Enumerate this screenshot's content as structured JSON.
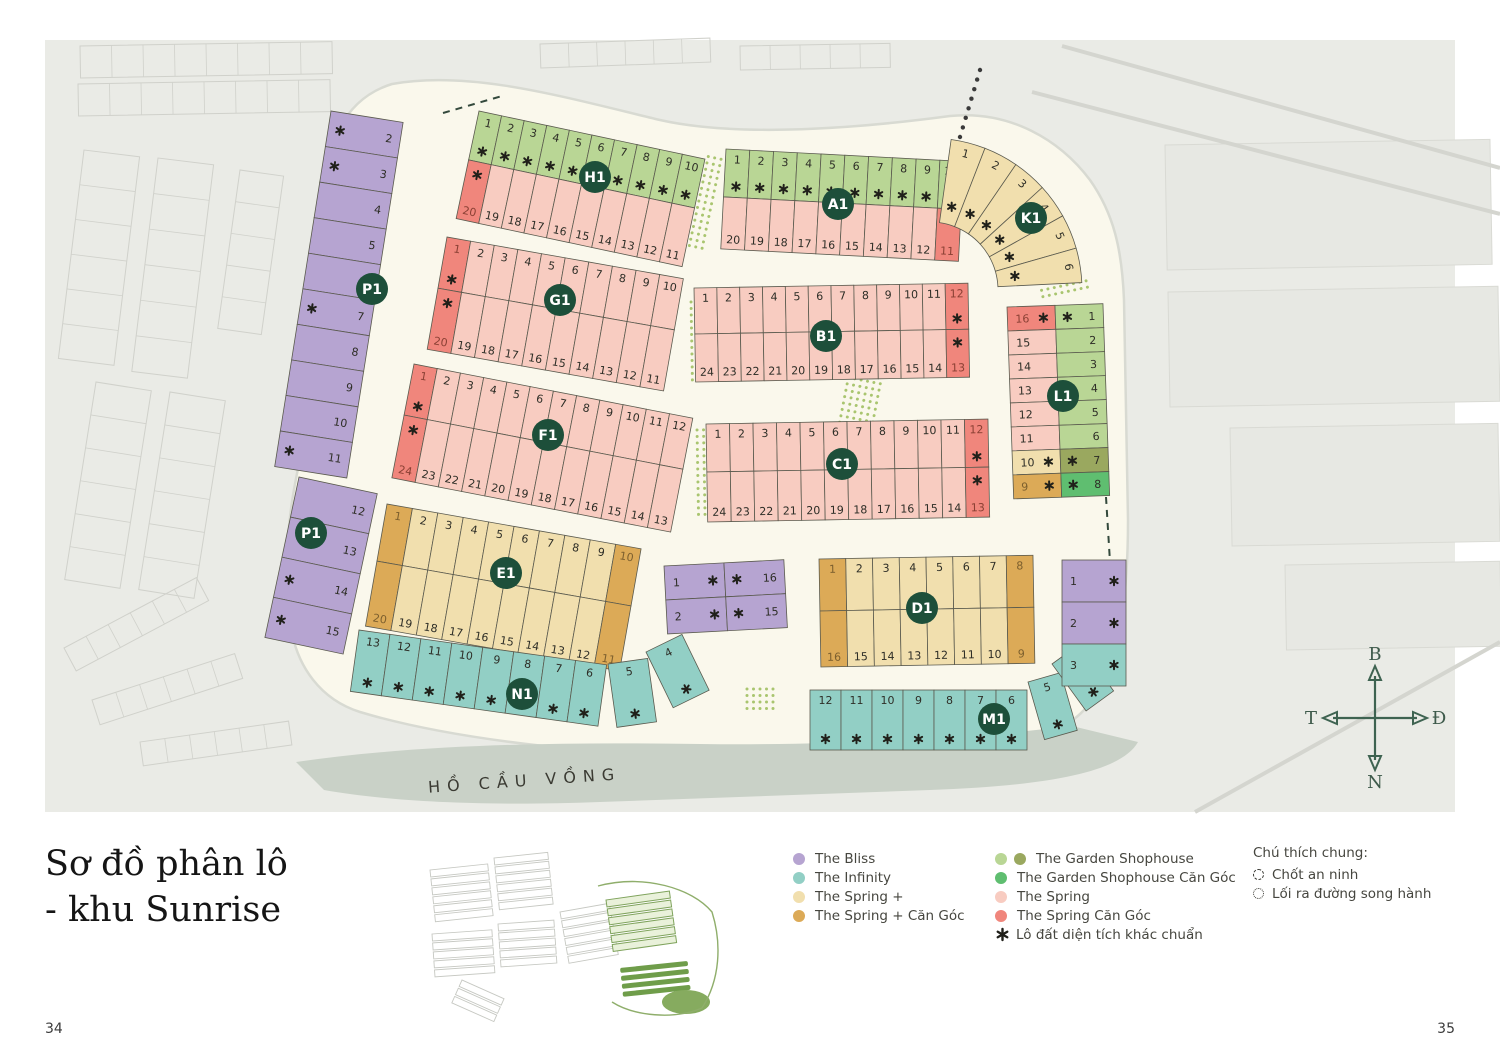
{
  "page": {
    "number_left": "34",
    "number_right": "35"
  },
  "title": {
    "line1": "Sơ đồ phân lô",
    "line2": "- khu Sunrise"
  },
  "map": {
    "lake_label": "HỒ CẦU VỒNG",
    "compass": {
      "north": "B",
      "south": "N",
      "west": "T",
      "east": "Đ"
    },
    "colors": {
      "b": "#b6a4d1",
      "i": "#92cfc5",
      "y": "#f1dfae",
      "Y": "#dcaa57",
      "g": "#b9d695",
      "o": "#9aa85f",
      "G": "#5fbe70",
      "p": "#f8ccc1",
      "r": "#f0867c"
    },
    "numColors": {
      "r": "#8a4034",
      "Y": "#7c5f2e",
      "default": "#2e2e27"
    },
    "badge_color": "#1d4f3a",
    "badges": [
      [
        "H1",
        595,
        177
      ],
      [
        "A1",
        838,
        204
      ],
      [
        "K1",
        1031,
        218
      ],
      [
        "P1",
        372,
        289
      ],
      [
        "G1",
        560,
        300
      ],
      [
        "B1",
        826,
        336
      ],
      [
        "L1",
        1063,
        396
      ],
      [
        "F1",
        548,
        435
      ],
      [
        "C1",
        842,
        464
      ],
      [
        "P1",
        311,
        533
      ],
      [
        "E1",
        506,
        573
      ],
      [
        "D1",
        922,
        608
      ],
      [
        "N1",
        522,
        694
      ],
      [
        "M1",
        994,
        719
      ]
    ],
    "blocks": {
      "strips": [
        {
          "id": "H1",
          "x": 479,
          "y": 111,
          "w": 231,
          "rot": 12,
          "rows": [
            {
              "h": 50,
              "side": "top",
              "nums": [
                "1",
                "2",
                "3",
                "4",
                "5",
                "6",
                "7",
                "8",
                "9",
                "10"
              ],
              "c": "g",
              "ast": [
                0,
                1,
                2,
                3,
                4,
                5,
                6,
                7,
                8,
                9
              ]
            },
            {
              "h": 60,
              "side": "bottom",
              "nums": [
                "20",
                "19",
                "18",
                "17",
                "16",
                "15",
                "14",
                "13",
                "12",
                "11"
              ],
              "c": "p",
              "corner": {
                "0": "r"
              },
              "ast": [
                0
              ]
            }
          ]
        },
        {
          "id": "A1",
          "x": 726,
          "y": 149,
          "w": 238,
          "rot": 3,
          "rows": [
            {
              "h": 48,
              "side": "top",
              "nums": [
                "1",
                "2",
                "3",
                "4",
                "5",
                "6",
                "7",
                "8",
                "9",
                "10"
              ],
              "c": "g",
              "ast": [
                0,
                1,
                2,
                3,
                4,
                5,
                6,
                7,
                8,
                9
              ]
            },
            {
              "h": 52,
              "side": "bottom",
              "nums": [
                "20",
                "19",
                "18",
                "17",
                "16",
                "15",
                "14",
                "13",
                "12",
                "11"
              ],
              "c": "p",
              "corner": {
                "9": "r"
              }
            }
          ]
        },
        {
          "id": "G1",
          "x": 447,
          "y": 237,
          "w": 240,
          "rot": 10,
          "rows": [
            {
              "h": 52,
              "side": "top",
              "nums": [
                "1",
                "2",
                "3",
                "4",
                "5",
                "6",
                "7",
                "8",
                "9",
                "10"
              ],
              "c": "p",
              "corner": {
                "0": "r"
              },
              "ast": [
                0
              ]
            },
            {
              "h": 62,
              "side": "bottom",
              "nums": [
                "20",
                "19",
                "18",
                "17",
                "16",
                "15",
                "14",
                "13",
                "12",
                "11"
              ],
              "c": "p",
              "corner": {
                "0": "r"
              },
              "ast": [
                0
              ]
            }
          ]
        },
        {
          "id": "B1",
          "x": 694,
          "y": 288,
          "w": 274,
          "rot": -1,
          "rows": [
            {
              "h": 46,
              "side": "top",
              "nums": [
                "1",
                "2",
                "3",
                "4",
                "5",
                "6",
                "7",
                "8",
                "9",
                "10",
                "11",
                "12"
              ],
              "c": "p",
              "corner": {
                "11": "r"
              },
              "ast": [
                11
              ]
            },
            {
              "h": 48,
              "side": "bottom",
              "nums": [
                "24",
                "23",
                "22",
                "21",
                "20",
                "19",
                "18",
                "17",
                "16",
                "15",
                "14",
                "13"
              ],
              "c": "p",
              "corner": {
                "11": "r"
              },
              "ast": [
                11
              ]
            }
          ]
        },
        {
          "id": "F1",
          "x": 414,
          "y": 364,
          "w": 284,
          "rot": 11,
          "rows": [
            {
              "h": 52,
              "side": "top",
              "nums": [
                "1",
                "2",
                "3",
                "4",
                "5",
                "6",
                "7",
                "8",
                "9",
                "10",
                "11",
                "12"
              ],
              "c": "p",
              "corner": {
                "0": "r"
              },
              "ast": [
                0
              ]
            },
            {
              "h": 64,
              "side": "bottom",
              "nums": [
                "24",
                "23",
                "22",
                "21",
                "20",
                "19",
                "18",
                "17",
                "16",
                "15",
                "14",
                "13"
              ],
              "c": "p",
              "corner": {
                "0": "r"
              },
              "ast": [
                0
              ]
            }
          ]
        },
        {
          "id": "C1",
          "x": 706,
          "y": 424,
          "w": 282,
          "rot": -1,
          "rows": [
            {
              "h": 48,
              "side": "top",
              "nums": [
                "1",
                "2",
                "3",
                "4",
                "5",
                "6",
                "7",
                "8",
                "9",
                "10",
                "11",
                "12"
              ],
              "c": "p",
              "corner": {
                "11": "r"
              },
              "ast": [
                11
              ]
            },
            {
              "h": 50,
              "side": "bottom",
              "nums": [
                "24",
                "23",
                "22",
                "21",
                "20",
                "19",
                "18",
                "17",
                "16",
                "15",
                "14",
                "13"
              ],
              "c": "p",
              "corner": {
                "11": "r"
              },
              "ast": [
                11
              ]
            }
          ]
        },
        {
          "id": "E1",
          "x": 387,
          "y": 504,
          "w": 258,
          "rot": 10,
          "rows": [
            {
              "h": 58,
              "side": "top",
              "nums": [
                "1",
                "2",
                "3",
                "4",
                "5",
                "6",
                "7",
                "8",
                "9",
                "10"
              ],
              "c": "y",
              "corner": {
                "0": "Y",
                "9": "Y"
              }
            },
            {
              "h": 66,
              "side": "bottom",
              "nums": [
                "20",
                "19",
                "18",
                "17",
                "16",
                "15",
                "14",
                "13",
                "12",
                "11"
              ],
              "c": "y",
              "corner": {
                "0": "Y",
                "9": "Y"
              }
            }
          ]
        },
        {
          "id": "D1",
          "x": 819,
          "y": 559,
          "w": 214,
          "rot": -1,
          "rows": [
            {
              "h": 52,
              "side": "top",
              "nums": [
                "1",
                "2",
                "3",
                "4",
                "5",
                "6",
                "7",
                "8"
              ],
              "c": "y",
              "corner": {
                "0": "Y",
                "7": "Y"
              }
            },
            {
              "h": 56,
              "side": "bottom",
              "nums": [
                "16",
                "15",
                "14",
                "13",
                "12",
                "11",
                "10",
                "9"
              ],
              "c": "y",
              "corner": {
                "0": "Y",
                "7": "Y"
              }
            }
          ]
        },
        {
          "id": "N1",
          "x": 359,
          "y": 630,
          "w": 250,
          "rot": 8,
          "rows": [
            {
              "h": 62,
              "side": "top",
              "nums": [
                "13",
                "12",
                "11",
                "10",
                "9",
                "8",
                "7",
                "6"
              ],
              "c": "i",
              "ast": [
                0,
                1,
                2,
                3,
                4,
                5,
                6,
                7
              ]
            }
          ]
        },
        {
          "id": "N1-5",
          "x": 608,
          "y": 664,
          "w": 40,
          "rot": -8,
          "rows": [
            {
              "h": 64,
              "side": "top",
              "nums": [
                "5"
              ],
              "c": "i",
              "ast": [
                0
              ]
            }
          ]
        },
        {
          "id": "N1-4",
          "x": 646,
          "y": 652,
          "w": 40,
          "rot": -26,
          "rows": [
            {
              "h": 62,
              "side": "top",
              "nums": [
                "4"
              ],
              "c": "i",
              "ast": [
                0
              ]
            }
          ]
        },
        {
          "id": "M1",
          "x": 810,
          "y": 690,
          "w": 217,
          "rot": 0,
          "rows": [
            {
              "h": 60,
              "side": "top",
              "nums": [
                "12",
                "11",
                "10",
                "9",
                "8",
                "7",
                "6"
              ],
              "c": "i",
              "ast": [
                0,
                1,
                2,
                3,
                4,
                5,
                6
              ]
            }
          ]
        },
        {
          "id": "M1-5",
          "x": 1028,
          "y": 682,
          "w": 34,
          "rot": -16,
          "rows": [
            {
              "h": 60,
              "side": "top",
              "nums": [
                "5"
              ],
              "c": "i",
              "ast": [
                0
              ]
            }
          ]
        },
        {
          "id": "M1-4",
          "x": 1052,
          "y": 664,
          "w": 34,
          "rot": -36,
          "rows": [
            {
              "h": 58,
              "side": "top",
              "nums": [
                "4"
              ],
              "c": "i",
              "ast": [
                0
              ]
            }
          ]
        }
      ],
      "vstrips": [
        {
          "id": "P1-upper",
          "x": 331,
          "y": 111,
          "rot": 9,
          "cols": [
            {
              "w": 73,
              "cellH": 36,
              "numSide": "right",
              "astSide": "left",
              "nums": [
                "2",
                "3",
                "4",
                "5",
                "6",
                "7",
                "8",
                "9",
                "10",
                "11"
              ],
              "c": "b",
              "ast": [
                0,
                1,
                5,
                9
              ]
            }
          ]
        },
        {
          "id": "P1-lower",
          "x": 299,
          "y": 477,
          "rot": 12,
          "cols": [
            {
              "w": 80,
              "cellH": 41,
              "numSide": "right",
              "astSide": "left",
              "nums": [
                "12",
                "13",
                "14",
                "15"
              ],
              "c": "b",
              "ast": [
                2,
                3
              ]
            }
          ]
        },
        {
          "id": "L1",
          "x": 1007,
          "y": 307,
          "rot": -2,
          "cols": [
            {
              "w": 48,
              "cellH": 24,
              "numSide": "left",
              "astSide": "right",
              "nums": [
                "16",
                "15",
                "14",
                "13",
                "12",
                "11",
                "10",
                "9"
              ],
              "c": "p",
              "corner": {
                "0": "r",
                "6": "y",
                "7": "Y"
              },
              "ast": [
                0,
                6,
                7
              ]
            },
            {
              "w": 48,
              "cellH": 24,
              "numSide": "right",
              "astSide": "left",
              "nums": [
                "1",
                "2",
                "3",
                "4",
                "5",
                "6",
                "7",
                "8"
              ],
              "c": "g",
              "corner": {
                "6": "o",
                "7": "G"
              },
              "ast": [
                0,
                6,
                7
              ]
            }
          ]
        },
        {
          "id": "bliss-mid",
          "x": 664,
          "y": 566,
          "rot": -3,
          "cols": [
            {
              "w": 60,
              "cellH": 34,
              "numSide": "left",
              "astSide": "right",
              "nums": [
                "1",
                "2"
              ],
              "c": "b",
              "ast": [
                0,
                1
              ]
            },
            {
              "w": 60,
              "cellH": 34,
              "numSide": "right",
              "astSide": "left",
              "nums": [
                "16",
                "15"
              ],
              "c": "b",
              "ast": [
                0,
                1
              ]
            }
          ]
        },
        {
          "id": "M1-right",
          "x": 1062,
          "y": 560,
          "rot": 0,
          "cols": [
            {
              "w": 64,
              "cellH": 42,
              "numSide": "left",
              "astSide": "right",
              "nums": [
                "1",
                "2",
                "3"
              ],
              "c": "b",
              "corner": {
                "2": "i"
              },
              "ast": [
                0,
                1,
                2
              ]
            }
          ]
        }
      ],
      "fans": [
        {
          "id": "K1",
          "cx": 930,
          "cy": 290,
          "r0": 68,
          "r1": 152,
          "start": -82,
          "step": 13.2,
          "nums": [
            "1",
            "2",
            "3",
            "4",
            "5",
            "6"
          ],
          "c": "y",
          "ast": [
            0,
            1,
            2,
            3,
            4,
            5
          ]
        }
      ]
    }
  },
  "legend": {
    "groups1": [
      {
        "label": "The Bliss",
        "colors": [
          "b"
        ]
      },
      {
        "label": "The Infinity",
        "colors": [
          "i"
        ]
      },
      {
        "label": "The Spring +",
        "colors": [
          "y"
        ]
      },
      {
        "label": "The Spring + Căn Góc",
        "colors": [
          "Y"
        ]
      }
    ],
    "groups2": [
      {
        "label": "The Garden Shophouse",
        "colors": [
          "g",
          "o"
        ]
      },
      {
        "label": "The Garden Shophouse Căn Góc",
        "colors": [
          "G"
        ]
      },
      {
        "label": "The Spring",
        "colors": [
          "p"
        ]
      },
      {
        "label": "The Spring Căn Góc",
        "colors": [
          "r"
        ]
      }
    ],
    "note": {
      "symbol": "✱",
      "label": "Lô đất diện tích khác chuẩn"
    },
    "general": {
      "title": "Chú thích chung:",
      "items": [
        {
          "icon": "dashed-circle",
          "label": "Chốt an ninh"
        },
        {
          "icon": "dotted-circle",
          "label": "Lối ra đường song hành"
        }
      ]
    }
  }
}
